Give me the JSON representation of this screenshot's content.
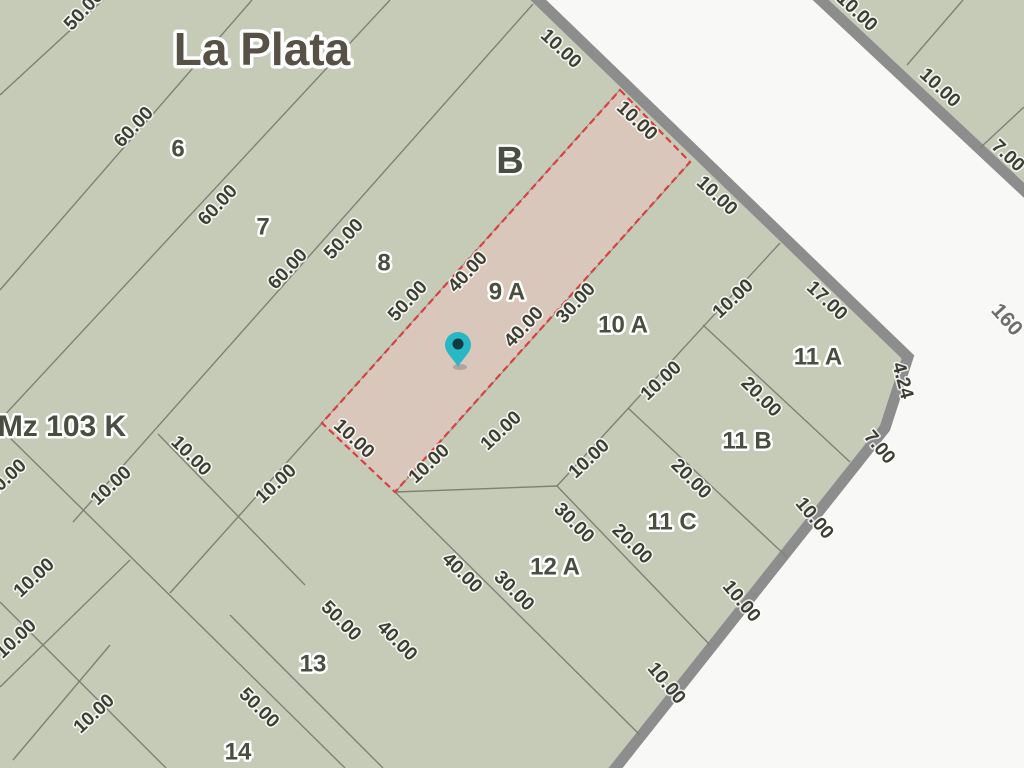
{
  "map": {
    "title": "La Plata",
    "block_letter": "B",
    "block_id": "Mz 103 K",
    "street_number": "160",
    "highlighted_parcel": "9 A",
    "colors": {
      "street_bg": "#f8f8f6",
      "block_fill": "#c6cbb8",
      "street_border": "#8d8d8d",
      "parcel_line": "#7d8274",
      "highlight_fill": "#d9c7ba",
      "highlight_border": "#d84040",
      "parcel_text": "#494e40",
      "dim_text": "#3b3f33",
      "title_text": "#575146",
      "street_text": "#6d6d6d",
      "pin_fill": "#28b7c5",
      "pin_core": "#133a42"
    },
    "main_block_polygon": "-10,-10 528,-10 908,357 885,428 610,775 -10,775",
    "main_block_street_edge": "528,-10 908,357 885,428 610,775",
    "opposite_block_polygon": "810,-10 1034,-10 1034,206 1030,196",
    "opposite_block_street_edge": "810,-10 1030,196",
    "highlight_polygon": "620,90 690,162 395,492 322,423",
    "parcel_lines": [
      {
        "x1": 0,
        "y1": 95,
        "x2": 103,
        "y2": 0
      },
      {
        "x1": 0,
        "y1": 290,
        "x2": 252,
        "y2": 0
      },
      {
        "x1": 0,
        "y1": 420,
        "x2": 390,
        "y2": 0
      },
      {
        "x1": 533,
        "y1": 4,
        "x2": 73,
        "y2": 522
      },
      {
        "x1": 620,
        "y1": 90,
        "x2": 170,
        "y2": 593
      },
      {
        "x1": 690,
        "y1": 162,
        "x2": 395,
        "y2": 492
      },
      {
        "x1": 395,
        "y1": 492,
        "x2": 640,
        "y2": 735
      },
      {
        "x1": 395,
        "y1": 492,
        "x2": 557,
        "y2": 486
      },
      {
        "x1": 780,
        "y1": 243,
        "x2": 557,
        "y2": 486
      },
      {
        "x1": 703,
        "y1": 325,
        "x2": 850,
        "y2": 462
      },
      {
        "x1": 628,
        "y1": 408,
        "x2": 787,
        "y2": 557
      },
      {
        "x1": 557,
        "y1": 486,
        "x2": 710,
        "y2": 645
      },
      {
        "x1": 0,
        "y1": 428,
        "x2": 345,
        "y2": 768
      },
      {
        "x1": 158,
        "y1": 434,
        "x2": 305,
        "y2": 585
      },
      {
        "x1": 230,
        "y1": 615,
        "x2": 383,
        "y2": 768
      },
      {
        "x1": 0,
        "y1": 602,
        "x2": 166,
        "y2": 768
      },
      {
        "x1": 0,
        "y1": 687,
        "x2": 130,
        "y2": 560
      },
      {
        "x1": 13,
        "y1": 760,
        "x2": 110,
        "y2": 645
      },
      {
        "x1": 907,
        "y1": 65,
        "x2": 963,
        "y2": 0
      },
      {
        "x1": 980,
        "y1": 148,
        "x2": 1024,
        "y2": 107
      }
    ],
    "parcel_labels": [
      {
        "text": "6",
        "x": 178,
        "y": 150,
        "size": 24
      },
      {
        "text": "7",
        "x": 263,
        "y": 228,
        "size": 24
      },
      {
        "text": "8",
        "x": 384,
        "y": 264,
        "size": 24
      },
      {
        "text": "9 A",
        "x": 507,
        "y": 293,
        "size": 24
      },
      {
        "text": "10 A",
        "x": 623,
        "y": 326,
        "size": 24
      },
      {
        "text": "11 A",
        "x": 818,
        "y": 358,
        "size": 24
      },
      {
        "text": "11 B",
        "x": 747,
        "y": 442,
        "size": 24
      },
      {
        "text": "11 C",
        "x": 672,
        "y": 523,
        "size": 24
      },
      {
        "text": "12 A",
        "x": 555,
        "y": 568,
        "size": 24
      },
      {
        "text": "13",
        "x": 313,
        "y": 665,
        "size": 24
      },
      {
        "text": "14",
        "x": 238,
        "y": 753,
        "size": 24
      }
    ],
    "dimension_labels": [
      {
        "text": "50.00",
        "x": 88,
        "y": 14,
        "rot": -47
      },
      {
        "text": "60.00",
        "x": 138,
        "y": 131,
        "rot": -47
      },
      {
        "text": "60.00",
        "x": 222,
        "y": 209,
        "rot": -47
      },
      {
        "text": "60.00",
        "x": 292,
        "y": 273,
        "rot": -47
      },
      {
        "text": "50.00",
        "x": 348,
        "y": 243,
        "rot": -47
      },
      {
        "text": "50.00",
        "x": 412,
        "y": 305,
        "rot": -47
      },
      {
        "text": "40.00",
        "x": 472,
        "y": 276,
        "rot": -47
      },
      {
        "text": "40.00",
        "x": 528,
        "y": 331,
        "rot": -47
      },
      {
        "text": "30.00",
        "x": 580,
        "y": 307,
        "rot": -47
      },
      {
        "text": "10.00",
        "x": 350,
        "y": 443,
        "rot": 43
      },
      {
        "text": "10.00",
        "x": 433,
        "y": 468,
        "rot": -43
      },
      {
        "text": "10.00",
        "x": 505,
        "y": 435,
        "rot": -43
      },
      {
        "text": "10.00",
        "x": 593,
        "y": 463,
        "rot": -43
      },
      {
        "text": "10.00",
        "x": 665,
        "y": 385,
        "rot": -43
      },
      {
        "text": "10.00",
        "x": 737,
        "y": 303,
        "rot": -43
      },
      {
        "text": "30.00",
        "x": 570,
        "y": 527,
        "rot": 45
      },
      {
        "text": "20.00",
        "x": 628,
        "y": 548,
        "rot": 45
      },
      {
        "text": "20.00",
        "x": 687,
        "y": 483,
        "rot": 45
      },
      {
        "text": "20.00",
        "x": 757,
        "y": 401,
        "rot": 45
      },
      {
        "text": "40.00",
        "x": 458,
        "y": 577,
        "rot": 45
      },
      {
        "text": "30.00",
        "x": 510,
        "y": 595,
        "rot": 45
      },
      {
        "text": "50.00",
        "x": 337,
        "y": 625,
        "rot": 45
      },
      {
        "text": "40.00",
        "x": 393,
        "y": 645,
        "rot": 45
      },
      {
        "text": "50.00",
        "x": 255,
        "y": 712,
        "rot": 45
      },
      {
        "text": "10.00",
        "x": 187,
        "y": 460,
        "rot": 45
      },
      {
        "text": "10.00",
        "x": 280,
        "y": 488,
        "rot": -43
      },
      {
        "text": "10.00",
        "x": 10,
        "y": 483,
        "rot": -43
      },
      {
        "text": "10.00",
        "x": 115,
        "y": 490,
        "rot": -43
      },
      {
        "text": "10.00",
        "x": 38,
        "y": 582,
        "rot": -43
      },
      {
        "text": "10.00",
        "x": 20,
        "y": 643,
        "rot": -43
      },
      {
        "text": "10.00",
        "x": 98,
        "y": 718,
        "rot": -43
      },
      {
        "text": "10.00",
        "x": 557,
        "y": 53,
        "rot": 43
      },
      {
        "text": "10.00",
        "x": 633,
        "y": 125,
        "rot": 43
      },
      {
        "text": "10.00",
        "x": 713,
        "y": 200,
        "rot": 43
      },
      {
        "text": "17.00",
        "x": 823,
        "y": 305,
        "rot": 43
      },
      {
        "text": "4.24",
        "x": 897,
        "y": 382,
        "rot": 75
      },
      {
        "text": "7.00",
        "x": 875,
        "y": 451,
        "rot": 50
      },
      {
        "text": "10.00",
        "x": 810,
        "y": 522,
        "rot": 50
      },
      {
        "text": "10.00",
        "x": 737,
        "y": 605,
        "rot": 50
      },
      {
        "text": "10.00",
        "x": 662,
        "y": 687,
        "rot": 50
      },
      {
        "text": "10.00",
        "x": 853,
        "y": 16,
        "rot": 43
      },
      {
        "text": "10.00",
        "x": 936,
        "y": 92,
        "rot": 43
      },
      {
        "text": "7.00",
        "x": 1004,
        "y": 160,
        "rot": 43
      }
    ],
    "title_pos": {
      "x": 262,
      "y": 53,
      "size": 46
    },
    "block_letter_pos": {
      "x": 510,
      "y": 163,
      "size": 38
    },
    "block_id_pos": {
      "x": 62,
      "y": 428,
      "size": 30
    },
    "street_number_pos": {
      "x": 1002,
      "y": 324,
      "size": 21,
      "rot": 48
    },
    "pin": {
      "x": 458,
      "y": 345
    }
  }
}
